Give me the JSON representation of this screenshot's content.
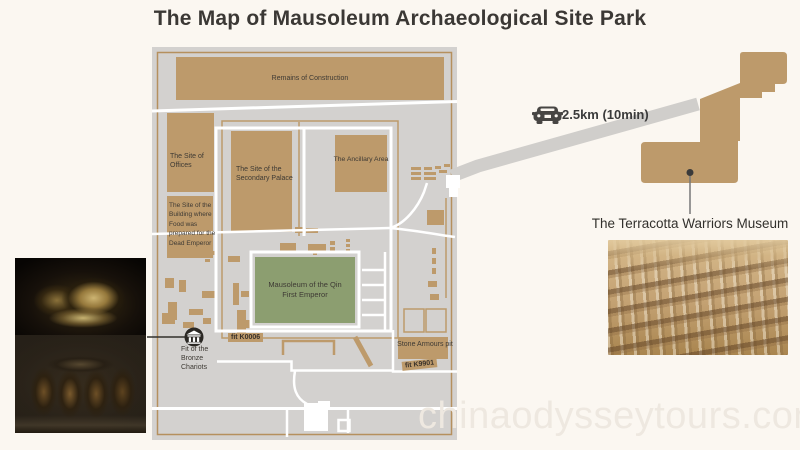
{
  "title": "The Map of Mausoleum Archaeological Site Park",
  "watermark": "chinaodysseytours.com",
  "map": {
    "sites": {
      "remains": {
        "label": "Remains of Construction"
      },
      "offices": {
        "label": "The Site of Offices"
      },
      "food_building": {
        "label": "The Site of the Building where Food was prepared for the Dead Emperor"
      },
      "secondary_palace": {
        "label": "The Site of the Secondary Palace"
      },
      "ancillary_area": {
        "label": "The Ancillary Area"
      },
      "mausoleum": {
        "label": "Mausoleum of the Qin First Emperor"
      },
      "bronze_chariots_pit": {
        "label": "Fit of the Bronze Chariots",
        "icon": "museum-building-icon"
      },
      "pit_k0006": {
        "label": "fit K0006"
      },
      "stone_armours_pit": {
        "label": "Stone Armours pit"
      },
      "pit_k9901": {
        "label": "fit K9901"
      }
    }
  },
  "route": {
    "distance_label": "2.5km (10min)",
    "icon": "car-icon"
  },
  "museum_callout": {
    "label": "The Terracotta Warriors Museum"
  },
  "colors": {
    "site_tan": "#bd9a6b",
    "map_gray": "#d3d1cf",
    "mausoleum_green": "#8c9e70",
    "background_cream": "#fbf7f1",
    "access_road_gray": "#d0cecb",
    "text": "#3e3a34"
  }
}
